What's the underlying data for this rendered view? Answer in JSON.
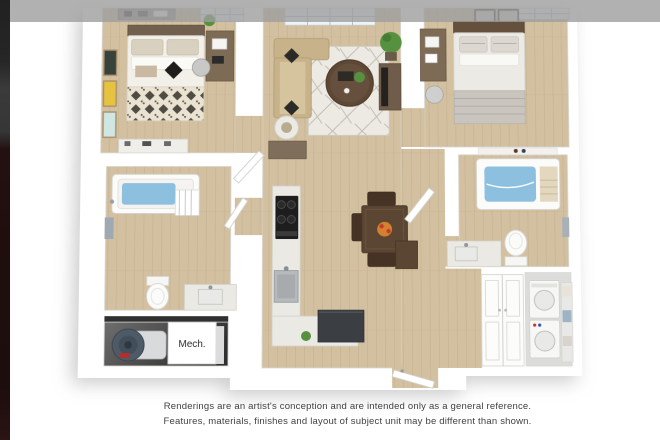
{
  "page": {
    "background_color": "#ffffff"
  },
  "chrome": {
    "top_bar_color": "rgba(158,158,158,0.8)",
    "left_strip_top_color": "#232323",
    "left_strip_maroon_color": "#1f0e0e"
  },
  "floorplan": {
    "type": "3d-floor-plan-rendering",
    "mech_label": "Mech.",
    "rooms": [
      "bedroom-left",
      "bathroom-left",
      "mechanical-closet",
      "living-room",
      "kitchen",
      "dining-area",
      "entry-hall",
      "bedroom-right",
      "bathroom-right",
      "laundry-closet",
      "entry-closet"
    ],
    "palette": {
      "wall_white": "#ffffff",
      "wood_floor": "#d3c0a0",
      "wood_line": "#c3ae8b",
      "rug_base": "#edeae3",
      "water_blue": "#8cc0de",
      "sofa_tan": "#c7b28a",
      "counter_speckle": "#ebe9e3",
      "appliance_dark": "#3b3e42",
      "stove_black": "#1d1d1d",
      "table_wood": "#5b4533",
      "chair_wood": "#473326",
      "plant_green": "#55913f",
      "heater_slate": "#4e5a66",
      "mech_floor": "#4f4f4f",
      "bar_gray": "rgba(158,158,158,0.8)",
      "strip_maroon": "#1f0e0e",
      "text_gray": "#414141"
    }
  },
  "disclaimer": {
    "line1": "Renderings are an artist's conception and are intended only as a general reference.",
    "line2": "Features, materials, finishes and layout of subject unit may be different than shown.",
    "text_color": "#414141"
  }
}
